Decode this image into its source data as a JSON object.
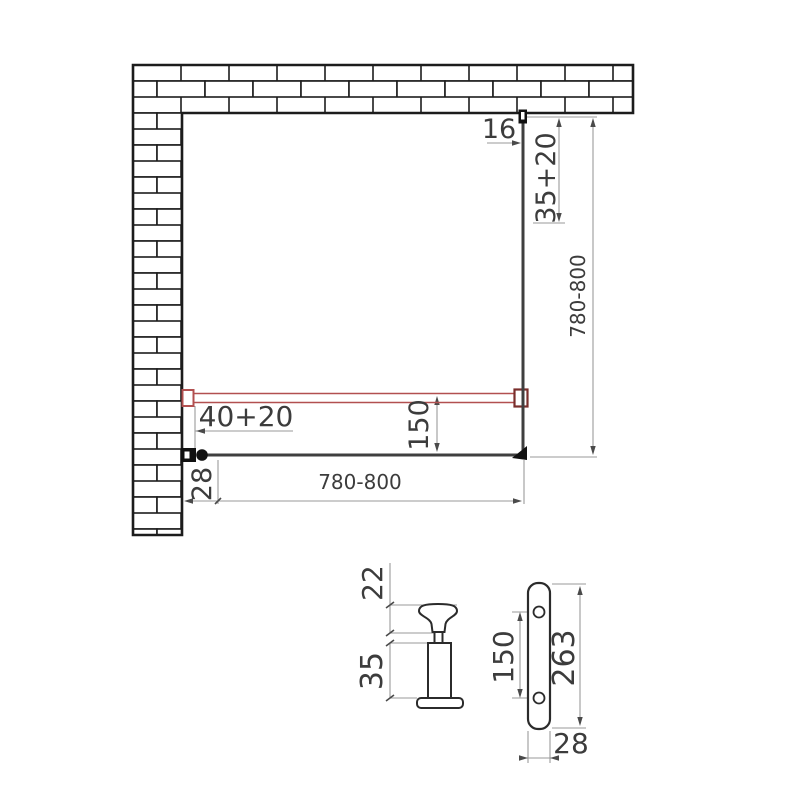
{
  "drawing": {
    "colors": {
      "background": "#ffffff",
      "wall_line": "#1c1c1c",
      "glass_line": "#3f3f3f",
      "dimension_line": "#9a9a9a",
      "dimension_text": "#3c3c3c",
      "support_bar_red": "#b25050",
      "support_bar_bracket_dark_red": "#7a2e2c"
    },
    "plan_view": {
      "dim_top_bracket_width": "16",
      "dim_wall_profile_adjust": "35+20",
      "dim_panel_right_width": "780-800",
      "dim_support_bar_adjust": "40+20",
      "dim_support_bar_offset": "150",
      "dim_wall_profile_width": "28",
      "dim_panel_bottom_width": "780-800"
    },
    "detail_knob": {
      "dim_cap_height": "22",
      "dim_body_height": "35"
    },
    "detail_wall_profile": {
      "dim_hole_spacing": "150",
      "dim_length": "263",
      "dim_width": "28"
    }
  }
}
